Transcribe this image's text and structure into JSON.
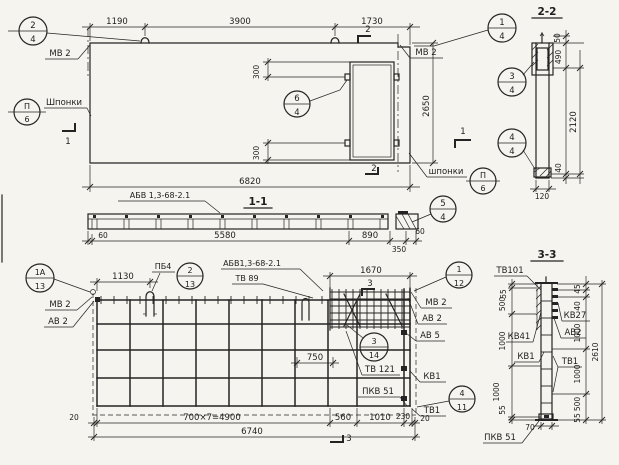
{
  "colors": {
    "paper": "#f6f4ee",
    "ink": "#242424"
  },
  "elevation": {
    "dim_1190": "1190",
    "dim_3900": "3900",
    "dim_1730": "1730",
    "dim_6820": "6820",
    "dim_2650": "2650",
    "dim_300_top": "300",
    "dim_300_bottom": "300",
    "label_mv2_left": "МВ 2",
    "label_mv2_right": "МВ 2",
    "label_keys_left": "Шпонки",
    "label_keys_right": "шпонки",
    "mark_1_left": "1",
    "mark_1_right": "1",
    "mark_2_top": "2",
    "mark_2_bottom": "2",
    "callout_2_4": {
      "top": "2",
      "bottom": "4"
    },
    "callout_1_4": {
      "top": "1",
      "bottom": "4"
    },
    "callout_6_4": {
      "top": "6",
      "bottom": "4"
    },
    "callout_p6_left": {
      "top": "П",
      "bottom": "6"
    },
    "callout_p6_right": {
      "top": "П",
      "bottom": "6"
    },
    "callout_5_4": {
      "top": "5",
      "bottom": "4"
    }
  },
  "section_1_1": {
    "title": "1-1",
    "label_abv": "АБВ 1,3-68-2.1",
    "dim_60_left": "60",
    "dim_5580": "5580",
    "dim_890": "890",
    "dim_350": "350",
    "dim_60_right": "60"
  },
  "section_2_2": {
    "title": "2-2",
    "dim_50": "50",
    "dim_490": "490",
    "dim_2120": "2120",
    "dim_40": "40",
    "dim_120": "120",
    "callout_3_4": {
      "top": "3",
      "bottom": "4"
    },
    "callout_4_4": {
      "top": "4",
      "bottom": "4"
    }
  },
  "plan": {
    "dim_1130": "1130",
    "dim_1670": "1670",
    "dim_750": "750",
    "dim_20_left": "20",
    "dim_4900": "700×7=4900",
    "dim_560": "560",
    "dim_1010": "1010",
    "dim_230": "230",
    "dim_20_right": "20",
    "dim_6740": "6740",
    "label_pb4": "ПБ4",
    "label_abv": "АБВ1,3-68-2.1",
    "label_tv89": "ТВ 89",
    "label_mv2_left": "МВ 2",
    "label_av2_left": "АВ 2",
    "label_mv2_right": "МВ 2",
    "label_av2_right": "АВ 2",
    "label_av5": "АВ 5",
    "label_tv121": "ТВ 121",
    "label_kv1": "КВ1",
    "label_pkv51": "ПКВ 51",
    "label_tv1": "ТВ1",
    "mark_3_top": "3",
    "mark_3_bottom": "3",
    "callout_1a_13": {
      "top": "1А",
      "bottom": "13"
    },
    "callout_2_13": {
      "top": "2",
      "bottom": "13"
    },
    "callout_1_12": {
      "top": "1",
      "bottom": "12"
    },
    "callout_3_14": {
      "top": "3",
      "bottom": "14"
    },
    "callout_4_11": {
      "top": "4",
      "bottom": "11"
    }
  },
  "section_3_3": {
    "title": "3-3",
    "label_tv101": "ТВ101",
    "label_kv27": "КВ27",
    "label_av2": "АВ2",
    "label_kv41": "КВ41",
    "label_kv1": "КВ1",
    "label_tv1": "ТВ1",
    "label_pkv51": "ПКВ 51",
    "dim_left_55_top": "55",
    "dim_left_500": "500",
    "dim_left_1000_a": "1000",
    "dim_left_1000_b": "1000",
    "dim_left_55_bottom": "55",
    "dim_right_45": "45",
    "dim_right_40": "40",
    "dim_right_1000_a": "1000",
    "dim_right_1000_b": "1000",
    "dim_right_500": "500",
    "dim_right_55": "55",
    "dim_total_2610": "2610",
    "dim_70": "70"
  }
}
